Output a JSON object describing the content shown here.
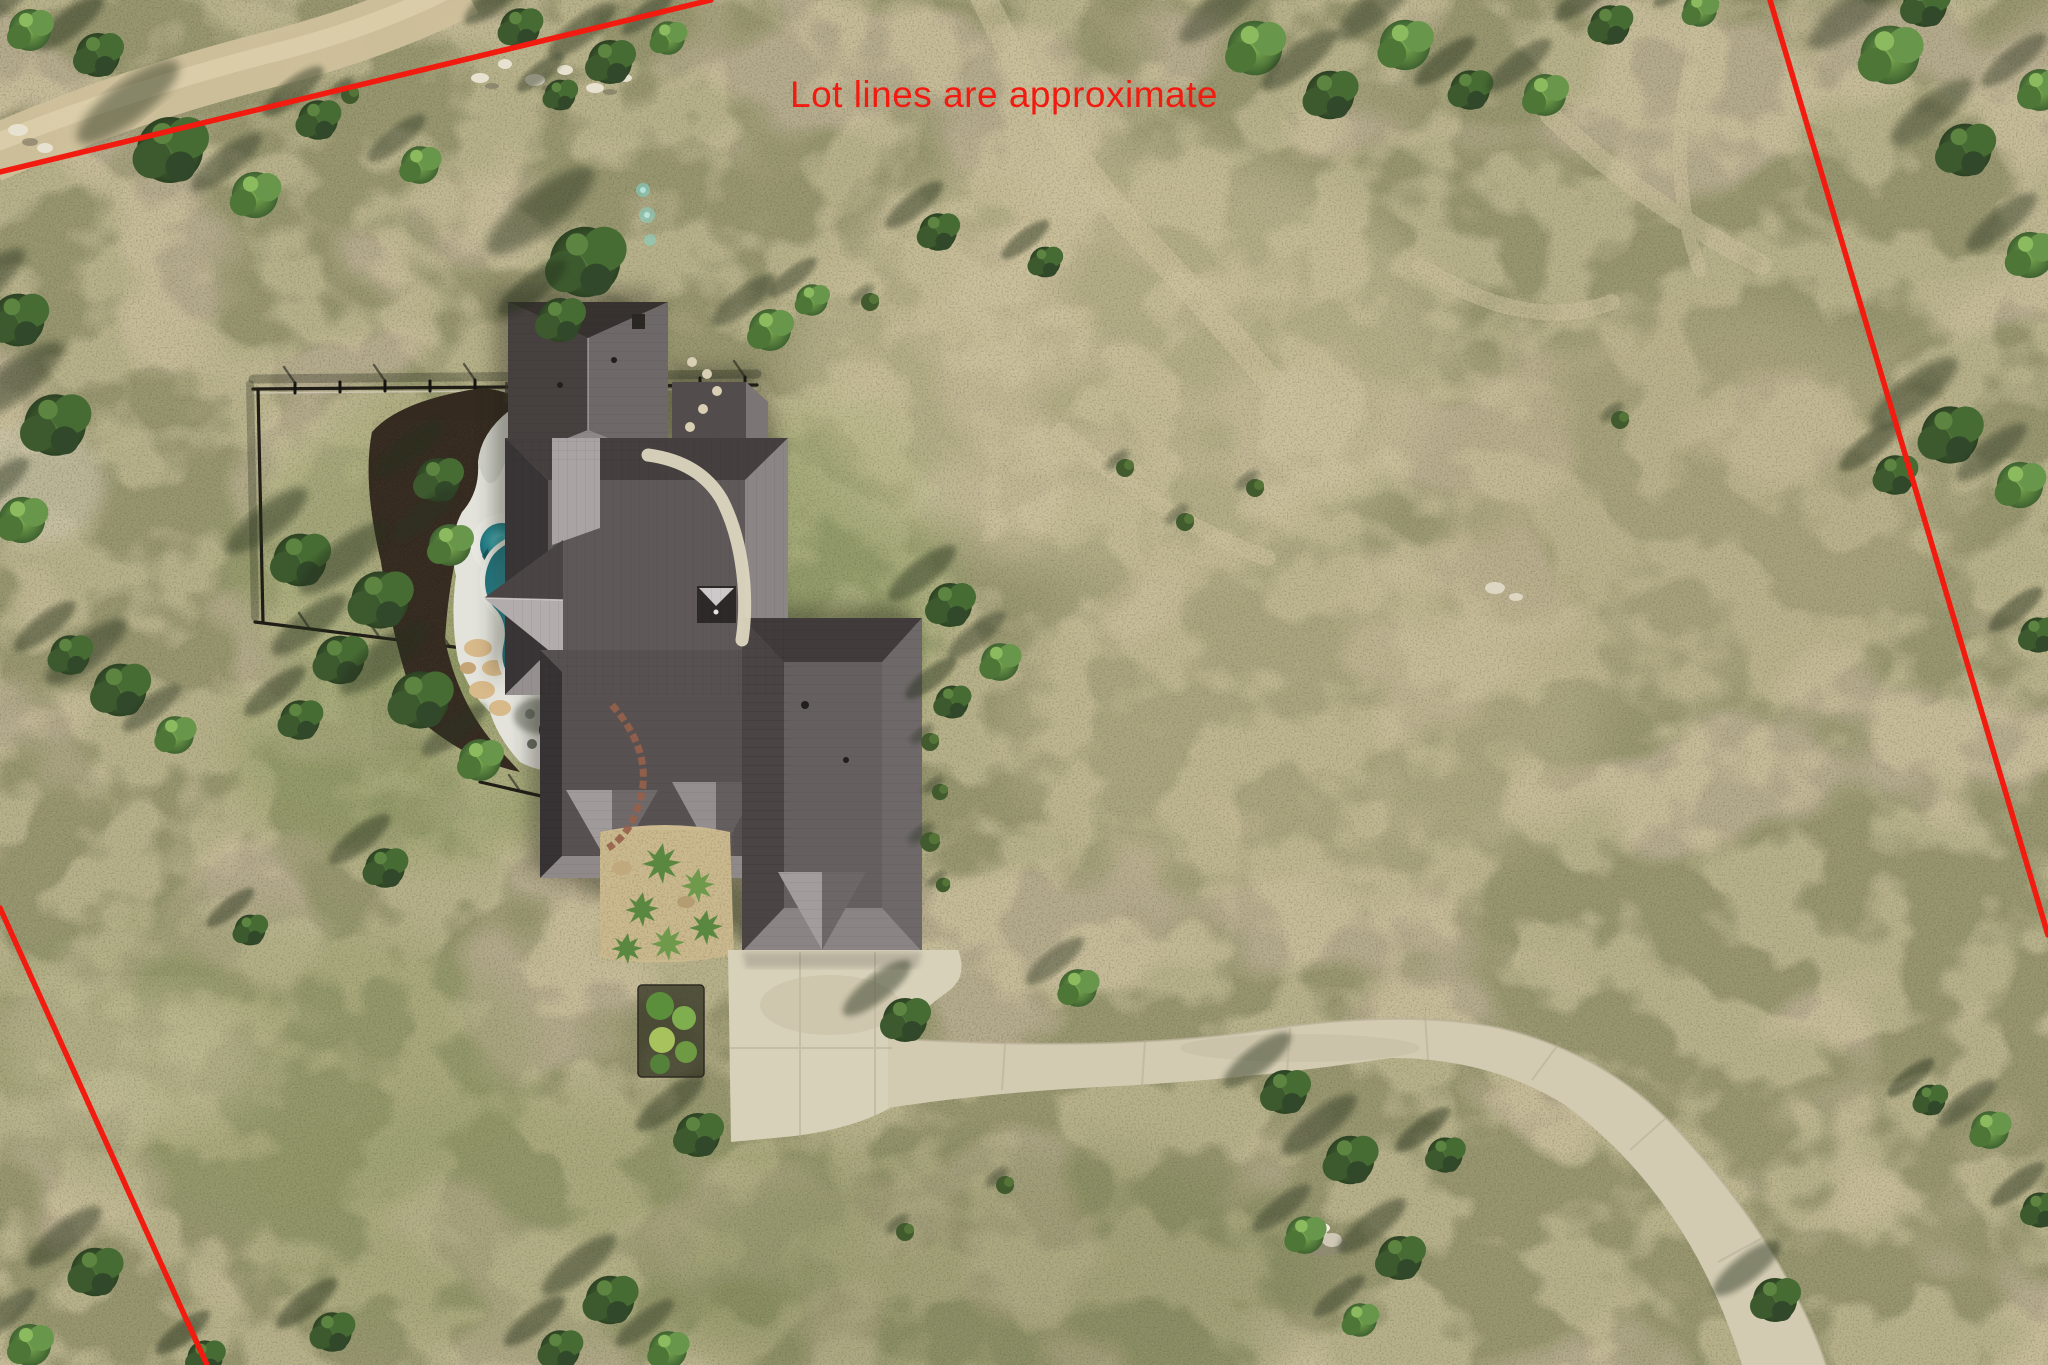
{
  "image": {
    "width": 2048,
    "height": 1365,
    "kind": "aerial-drone-photo"
  },
  "annotation": {
    "disclaimer_text": "Lot lines are approximate",
    "color": "#f21b10"
  },
  "lot_lines": {
    "color": "#f21b10",
    "stroke_px": 5.5,
    "segments": [
      {
        "name": "north-west-boundary",
        "x1": 0,
        "y1": 172,
        "x2": 711,
        "y2": 0
      },
      {
        "name": "north-east-boundary",
        "x1": 1770,
        "y1": 0,
        "x2": 2048,
        "y2": 935
      },
      {
        "name": "south-west-boundary",
        "x1": 0,
        "y1": 908,
        "x2": 207,
        "y2": 1365
      }
    ]
  },
  "scene": {
    "type": "aerial-photo",
    "features": {
      "house": "dark standing-seam metal hip/gable roof",
      "pool": "kidney-shaped teal pool with round spa",
      "deck": "white concrete pool deck",
      "fire_pit": "round fire pit with chairs on deck",
      "fence": "black metal fence around backyard",
      "driveway": "long curved concrete driveway",
      "terrain": "dry tan grass field with oak and juniper trees",
      "trail": "dirt road along upper-left boundary",
      "rock_pile": "white rock pile in lower field"
    },
    "palette": {
      "field_tan": "#b3a98b",
      "field_green": "#7d8454",
      "tree_dark": "#2c4223",
      "tree_light": "#6fa14c",
      "roof_dark": "#3b3536",
      "roof_light": "#9e989a",
      "pool_teal": "#2d8f98",
      "deck_white": "#e3e3dc",
      "concrete": "#d5cdb5",
      "mulch": "#342a20"
    }
  }
}
